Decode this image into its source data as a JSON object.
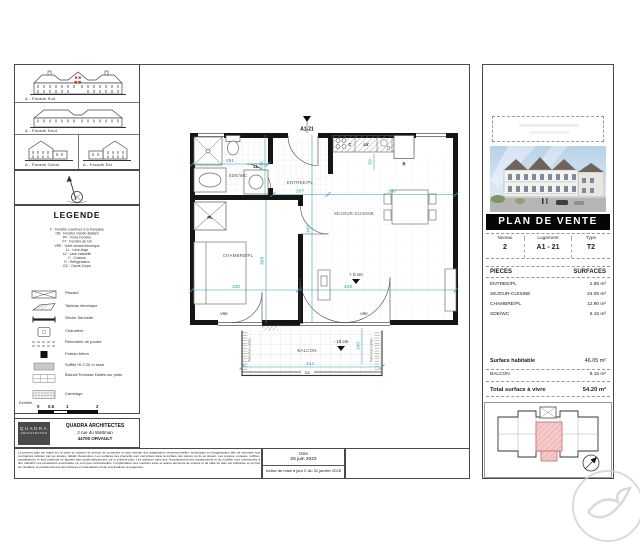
{
  "colors": {
    "dimension_teal": "#2f9dad",
    "banner_bg": "#000000",
    "unit_highlight_pink": "#f3bcbc",
    "facade_accent_red": "#c0392b"
  },
  "left_panel": {
    "facades": [
      "A - Facade Sud",
      "A - Facade Nord",
      "A - Facade Ouest",
      "A - Facade Est"
    ],
    "legende": {
      "title": "LEGENDE",
      "abbreviations": [
        "F : Fenêtre ouverture à la française",
        "OB : Fenêtre Oscillo-Battant",
        "PF : Porte Fenêtre",
        "FT : Fenêtre de toit",
        "VRE : Volet roulant électrique",
        "LL : Lave-linge",
        "LV : Lave vaisselle",
        "C : Cuisson",
        "R : Réfrigérateur",
        "GC : Garde-Corps"
      ],
      "symbols": [
        {
          "label": "Placard"
        },
        {
          "label": "Tableau électrique"
        },
        {
          "label": "Sèche Serviette"
        },
        {
          "label": "Chaudière"
        },
        {
          "label": "Retombée de poutre"
        },
        {
          "label": "Poteau béton"
        },
        {
          "label": "Soffite Ht 2.20 m maxi"
        },
        {
          "label": "Balcon/Terrasse Dalles sur plots"
        },
        {
          "label": "Carrelage"
        }
      ],
      "echelle": {
        "label": "Echelle",
        "ticks": [
          "0",
          "0.5",
          "1",
          "2"
        ]
      }
    },
    "architect": {
      "logo_line1": "QUADRA",
      "logo_line2": "ARCHITECTES",
      "name": "QUADRA ARCHITECTES",
      "address": "2 rue du Wattman",
      "city": "44700 ORVAULT"
    }
  },
  "plan": {
    "section_marker": "A1-21",
    "rooms": {
      "sde": "SDE/WC",
      "entree": "ENTREE/PL",
      "sejour": "SEJOUR-CUISINE",
      "chambre": "CHAMBRE/PL",
      "balcon": "BALCON"
    },
    "labels": {
      "ll": "LL",
      "lv": "LV",
      "c": "C",
      "r": "R",
      "pl": "PL",
      "gc": "GC",
      "vre": "VRE",
      "pare_vue": "Pare-Vue Lames"
    },
    "levels": {
      "sejour": "+ 0 cm",
      "balcon": "- 10 cm"
    },
    "dims": {
      "sde_w": "291",
      "sde_h": "211",
      "entree_w": "207",
      "kitchen_w": "350",
      "niche": "50",
      "chambre_w": "330",
      "chambre_h": "368",
      "sejour_w": "428",
      "sejour_h": "469",
      "balcon_w": "444",
      "balcon_d": "160"
    }
  },
  "right_panel": {
    "banner": "PLAN DE VENTE",
    "unit": {
      "niveau_label": "Niveau",
      "niveau": "2",
      "logement_label": "Logement",
      "logement": "A1 - 21",
      "type_label": "Type",
      "type": "T2"
    },
    "table": {
      "pieces_header": "PIECES",
      "surfaces_header": "SURFACES",
      "rows": [
        {
          "name": "ENTREE/PL",
          "area": "2.95 m²"
        },
        {
          "name": "SEJOUR-CUISINE",
          "area": "24.05 m²"
        },
        {
          "name": "CHAMBRE/PL",
          "area": "12.90 m²"
        },
        {
          "name": "SDE/WC",
          "area": "6.15 m²"
        }
      ]
    },
    "totals": {
      "habitable_label": "Surface habitable",
      "habitable": "46.05 m²",
      "balcon_label": "BALCON",
      "balcon": "8.15 m²",
      "total_label": "Total surface à vivre",
      "total": "54.20 m²"
    }
  },
  "footer": {
    "disclaimer": "Le présent plan est établi sur la base du dossier de permis de construire et peut évoluer des adaptations dimensionnelles, techniques et d'organisation afin de répondre aux contraintes induites par les études, détails d'exécution. Les surfaces des placards sont comprises dans la surface des pièces où ils se situent. Les poutres, poteaux, soffites, canalisations et faux plafonds ne figurent pas systématiquement sur le présent plan. Les surfaces ainsi que l'emplacement des équipements et du mobilier sont mentionnés à titre indicatif. Les prestations éventuelles ne sont pas contractuelles. L'implantation des meubles évier et autres éléments de cuisine et de salle de bain est indicative et permet de visualiser le positionnement des arrivées et évacuations d'eau à la livraison du logement.",
    "date_label": "Date",
    "date_value": "26 juin 2023",
    "revision": "Indice de mise à jour C du 31 janvier 2025"
  }
}
